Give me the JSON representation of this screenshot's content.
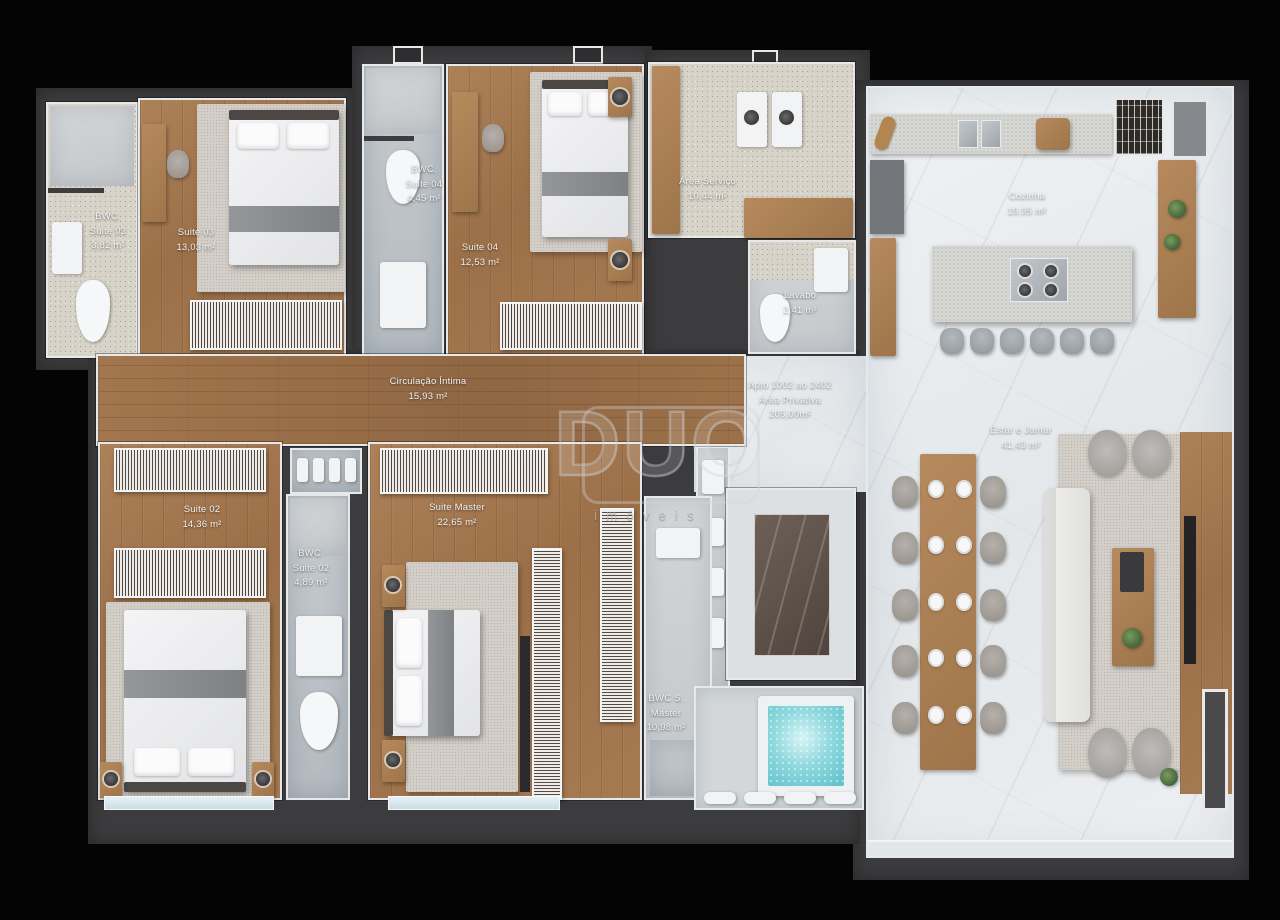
{
  "watermark": {
    "logo": "DUO",
    "tagline": "imóveis"
  },
  "rooms": {
    "bwc_suite03": {
      "l1": "BWC.",
      "l2": "Suite 03",
      "area": "3,82 m²"
    },
    "suite03": {
      "l1": "Suite 03",
      "area": "13,03 m²"
    },
    "bwc_suite04": {
      "l1": "BWC.",
      "l2": "Suite 04",
      "area": "4,45 m²"
    },
    "suite04": {
      "l1": "Suite 04",
      "area": "12,53 m²"
    },
    "area_servico": {
      "l1": "Área Serviço",
      "area": "10,44 m²"
    },
    "lavabo": {
      "l1": "Lavabo",
      "area": "2,41 m²"
    },
    "cozinha": {
      "l1": "Cozinha",
      "area": "19,95 m²"
    },
    "circulacao": {
      "l1": "Circulação Íntima",
      "area": "15,93 m²"
    },
    "apto": {
      "l1": "Apto 1002 ao 2402",
      "l2": "Área Privativa",
      "area": "205,00m²"
    },
    "estar_jantar": {
      "l1": "Estar e Jantar",
      "area": "41,43 m²"
    },
    "suite02": {
      "l1": "Suite 02",
      "area": "14,36 m²"
    },
    "bwc_suite02": {
      "l1": "BWC.",
      "l2": "Suite 02",
      "area": "4,89 m²"
    },
    "suite_master": {
      "l1": "Suite Master",
      "area": "22,65 m²"
    },
    "bwc_master": {
      "l1": "BWC S.",
      "l2": "Master",
      "area": "10,98 m²"
    }
  },
  "colors": {
    "wall": "#3c3c3e",
    "wood_floor": "#a07a52",
    "marble_floor": "#eceff1",
    "water": "#6cc9d4"
  }
}
